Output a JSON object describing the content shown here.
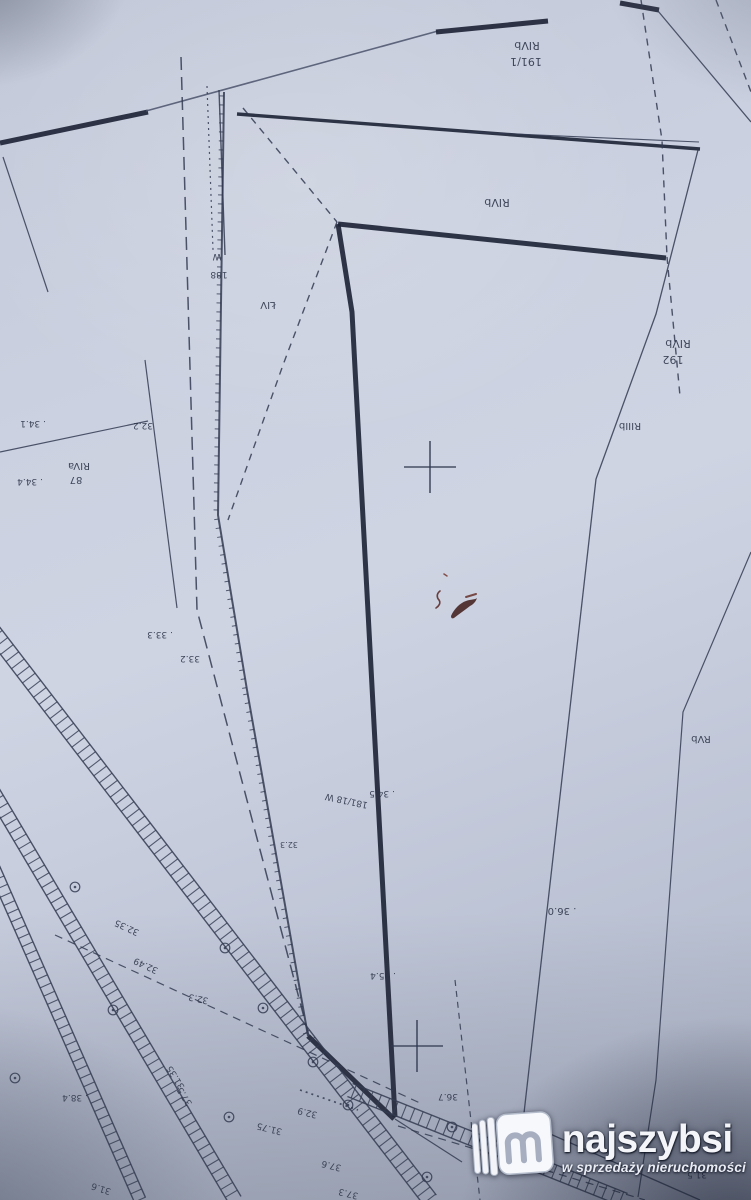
{
  "meta": {
    "kind": "photographed cadastral survey map (Polish parcel map, sheet rotated 180°)",
    "width": 751,
    "height": 1200
  },
  "palette": {
    "paper": "#c9cfdf",
    "line_thin": "#333b52",
    "line_thick": "#1f2637",
    "line_pencil": "#4a526b",
    "label_ink": "#2b3347",
    "scribble_red": "#44201e",
    "watermark_text": "#f3f5f9"
  },
  "watermark": {
    "brand": "najszybsi",
    "tagline": "w sprzedaży nieruchomości",
    "icon": "najszybsi-m-book-logo"
  },
  "map": {
    "lines": [
      {
        "n": "road-edge-thick",
        "pts": [
          [
            0,
            143
          ],
          [
            148,
            112
          ]
        ],
        "w": 5,
        "c": "thick"
      },
      {
        "n": "boundary-pencil",
        "pts": [
          [
            146,
            111
          ],
          [
            438,
            31
          ]
        ],
        "w": 1.6,
        "c": "pencil"
      },
      {
        "n": "boundary-thick",
        "pts": [
          [
            436,
            32
          ],
          [
            548,
            21
          ]
        ],
        "w": 5,
        "c": "thick"
      },
      {
        "n": "boundary-thick-short",
        "pts": [
          [
            620,
            3
          ],
          [
            659,
            10
          ]
        ],
        "w": 5,
        "c": "thick"
      },
      {
        "n": "road-upper",
        "pts": [
          [
            237,
            114
          ],
          [
            700,
            149
          ]
        ],
        "w": 3.4,
        "c": "thick"
      },
      {
        "n": "road-upper-parallel",
        "pts": [
          [
            468,
            132
          ],
          [
            699,
            142
          ]
        ],
        "w": 1.1
      },
      {
        "n": "parcel-top-thick",
        "pts": [
          [
            338,
            224
          ],
          [
            666,
            258
          ]
        ],
        "w": 5,
        "c": "thick"
      },
      {
        "n": "parcel-left-thick",
        "pts": [
          [
            338,
            224
          ],
          [
            352,
            312
          ],
          [
            395,
            1117
          ]
        ],
        "w": 5,
        "c": "thick"
      },
      {
        "n": "parcel-jog-thick",
        "pts": [
          [
            308,
            1036
          ],
          [
            394,
            1119
          ]
        ],
        "w": 5,
        "c": "thick"
      },
      {
        "n": "serrated-boundary",
        "pts": [
          [
            224,
            92
          ],
          [
            218,
            515
          ],
          [
            247,
            690
          ],
          [
            285,
            905
          ],
          [
            308,
            1036
          ]
        ],
        "w": 2,
        "ticks": true
      },
      {
        "n": "boundary-line",
        "pts": [
          [
            658,
            11
          ],
          [
            751,
            122
          ]
        ],
        "w": 1.3
      },
      {
        "n": "boundary-line",
        "pts": [
          [
            698,
            150
          ],
          [
            656,
            314
          ],
          [
            596,
            479
          ]
        ],
        "w": 1.3
      },
      {
        "n": "parcel-right-line",
        "pts": [
          [
            596,
            479
          ],
          [
            523,
            1122
          ]
        ],
        "w": 1.3
      },
      {
        "n": "boundary-line",
        "pts": [
          [
            523,
            1122
          ],
          [
            700,
            1200
          ]
        ],
        "w": 1.3
      },
      {
        "n": "boundary-line",
        "pts": [
          [
            145,
            360
          ],
          [
            177,
            608
          ]
        ],
        "w": 1.2
      },
      {
        "n": "boundary-line",
        "pts": [
          [
            0,
            452
          ],
          [
            148,
            421
          ]
        ],
        "w": 1.2
      },
      {
        "n": "boundary-line",
        "pts": [
          [
            3,
            157
          ],
          [
            48,
            292
          ]
        ],
        "w": 1.2
      },
      {
        "n": "boundary-line",
        "pts": [
          [
            219,
            90
          ],
          [
            225,
            255
          ]
        ],
        "w": 1.4
      },
      {
        "n": "boundary-line",
        "pts": [
          [
            751,
            552
          ],
          [
            683,
            712
          ],
          [
            656,
            1080
          ],
          [
            638,
            1197
          ]
        ],
        "w": 1.2
      },
      {
        "n": "boundary-line",
        "pts": [
          [
            395,
            1119
          ],
          [
            462,
            1162
          ]
        ],
        "w": 1.2
      },
      {
        "n": "dashed-boundary",
        "pts": [
          [
            716,
            0
          ],
          [
            751,
            92
          ]
        ],
        "dash": "7 6",
        "w": 1.4
      },
      {
        "n": "dashed-boundary",
        "pts": [
          [
            641,
            0
          ],
          [
            662,
            140
          ],
          [
            667,
            257
          ]
        ],
        "dash": "7 6",
        "w": 1.4
      },
      {
        "n": "dashed-boundary",
        "pts": [
          [
            667,
            257
          ],
          [
            680,
            396
          ]
        ],
        "dash": "7 6",
        "w": 1.4
      },
      {
        "n": "dashed-boundary",
        "pts": [
          [
            243,
            108
          ],
          [
            337,
            222
          ]
        ],
        "dash": "7 6",
        "w": 1.4
      },
      {
        "n": "dashed-boundary",
        "pts": [
          [
            337,
            222
          ],
          [
            283,
            365
          ],
          [
            228,
            520
          ]
        ],
        "dash": "7 6",
        "w": 1.4
      },
      {
        "n": "chain-line",
        "pts": [
          [
            181,
            57
          ],
          [
            197,
            610
          ],
          [
            310,
            1040
          ]
        ],
        "dash": "13 7",
        "w": 1.5
      },
      {
        "n": "dashed-boundary",
        "pts": [
          [
            55,
            935
          ],
          [
            420,
            1103
          ]
        ],
        "dash": "8 6",
        "w": 1.2
      },
      {
        "n": "dashed-boundary",
        "pts": [
          [
            398,
            1126
          ],
          [
            645,
            1200
          ]
        ],
        "dash": "8 6",
        "w": 1.2
      },
      {
        "n": "dotted-line",
        "pts": [
          [
            207,
            86
          ],
          [
            213,
            250
          ]
        ],
        "dash": "2 4",
        "w": 1.2
      },
      {
        "n": "dashed-boundary",
        "pts": [
          [
            455,
            980
          ],
          [
            480,
            1200
          ]
        ],
        "dash": "6 5",
        "w": 1.2
      },
      {
        "n": "dotted-line",
        "pts": [
          [
            300,
            1090
          ],
          [
            358,
            1110
          ]
        ],
        "dash": "2 4",
        "w": 1.7
      }
    ],
    "bands": [
      {
        "n": "hatched-road-band",
        "from": [
          -12,
          625
        ],
        "to": [
          430,
          1200
        ],
        "gap": 16,
        "rung": 9
      },
      {
        "n": "hatched-road-band",
        "from": [
          -14,
          780
        ],
        "to": [
          235,
          1200
        ],
        "gap": 14,
        "rung": 9
      },
      {
        "n": "hatched-road-band",
        "from": [
          -14,
          850
        ],
        "to": [
          140,
          1200
        ],
        "gap": 12,
        "rung": 9
      },
      {
        "n": "hatched-road-band",
        "from": [
          350,
          1090
        ],
        "to": [
          625,
          1200
        ],
        "gap": 14,
        "rung": 9
      }
    ],
    "crosses": [
      {
        "x": 430,
        "y": 467,
        "arm": 26
      },
      {
        "x": 417,
        "y": 1046,
        "arm": 26
      }
    ],
    "survey_points": [
      [
        113,
        1010
      ],
      [
        75,
        887
      ],
      [
        225,
        948
      ],
      [
        263,
        1008
      ],
      [
        313,
        1062
      ],
      [
        348,
        1105
      ],
      [
        452,
        1127
      ],
      [
        427,
        1177
      ],
      [
        15,
        1078
      ],
      [
        229,
        1117
      ]
    ],
    "labels": [
      {
        "t": "RIVb",
        "x": 527,
        "y": 42,
        "s": 11
      },
      {
        "t": "191/1",
        "x": 526,
        "y": 58,
        "s": 11
      },
      {
        "t": "RIVb",
        "x": 497,
        "y": 199,
        "s": 11
      },
      {
        "t": "RIVb",
        "x": 678,
        "y": 340,
        "s": 11
      },
      {
        "t": "192",
        "x": 673,
        "y": 356,
        "s": 11
      },
      {
        "t": "RIIIb",
        "x": 630,
        "y": 423,
        "s": 10
      },
      {
        "t": "RIVa",
        "x": 79,
        "y": 463,
        "s": 10
      },
      {
        "t": "87",
        "x": 76,
        "y": 477,
        "s": 10
      },
      {
        "t": ". 34.1",
        "x": 33,
        "y": 421,
        "s": 9
      },
      {
        "t": ". 34.4",
        "x": 30,
        "y": 479,
        "s": 9
      },
      {
        "t": "32.2",
        "x": 143,
        "y": 423,
        "s": 9
      },
      {
        "t": ". 33.3",
        "x": 160,
        "y": 632,
        "s": 9
      },
      {
        "t": "33.2",
        "x": 190,
        "y": 656,
        "s": 9
      },
      {
        "t": "181/18 W",
        "x": 347,
        "y": 798,
        "s": 9,
        "r": 12
      },
      {
        "t": ". 34.5",
        "x": 382,
        "y": 791,
        "s": 9
      },
      {
        "t": "32.3",
        "x": 289,
        "y": 842,
        "s": 8
      },
      {
        "t": ". 36.0",
        "x": 562,
        "y": 908,
        "s": 10
      },
      {
        "t": "RVb",
        "x": 701,
        "y": 736,
        "s": 10
      },
      {
        "t": ". 35.4",
        "x": 383,
        "y": 973,
        "s": 9
      },
      {
        "t": "36.7",
        "x": 448,
        "y": 1094,
        "s": 9
      },
      {
        "t": "32.49",
        "x": 147,
        "y": 963,
        "s": 9,
        "r": 25
      },
      {
        "t": "32.35",
        "x": 128,
        "y": 925,
        "s": 9,
        "r": 25
      },
      {
        "t": "32.3",
        "x": 199,
        "y": 996,
        "s": 9,
        "r": 12
      },
      {
        "t": ". 38.4",
        "x": 75,
        "y": 1095,
        "s": 9
      },
      {
        "t": "31.6",
        "x": 102,
        "y": 1186,
        "s": 9,
        "r": 18
      },
      {
        "t": "31.35",
        "x": 178,
        "y": 1076,
        "s": 9,
        "r": 58
      },
      {
        "t": "37.5",
        "x": 187,
        "y": 1095,
        "s": 9,
        "r": 58
      },
      {
        "t": "31.75",
        "x": 270,
        "y": 1126,
        "s": 9,
        "r": 14
      },
      {
        "t": "32.9",
        "x": 308,
        "y": 1110,
        "s": 9,
        "r": 14
      },
      {
        "t": "37.6",
        "x": 332,
        "y": 1163,
        "s": 9,
        "r": 14
      },
      {
        "t": "37.3",
        "x": 349,
        "y": 1191,
        "s": 9,
        "r": 14
      },
      {
        "t": "31.5",
        "x": 697,
        "y": 1172,
        "s": 9
      },
      {
        "t": "W",
        "x": 217,
        "y": 254,
        "s": 9
      },
      {
        "t": "188",
        "x": 219,
        "y": 272,
        "s": 9
      },
      {
        "t": "ŁIV",
        "x": 268,
        "y": 302,
        "s": 10
      }
    ],
    "ink_scribble": [
      {
        "d": "M440,591 c-4,3 -3,7 -1,9 c2,3 0,6 -3,8",
        "stroke": "#5b2a28",
        "w": 1.6
      },
      {
        "d": "M451,616 c3,-7 9,-13 15,-15 c5,-2 9,-1 11,-3 c-1,3 -3,6 -7,8 c-5,4 -11,8 -16,12 c-2,1 -3,0 -3,-2 z",
        "fill": "#44201e"
      },
      {
        "d": "M466,597 l10,-3",
        "stroke": "#6b352f",
        "w": 2
      },
      {
        "d": "M444,574 l3,2",
        "stroke": "#7a3b33",
        "w": 1.5
      }
    ]
  }
}
